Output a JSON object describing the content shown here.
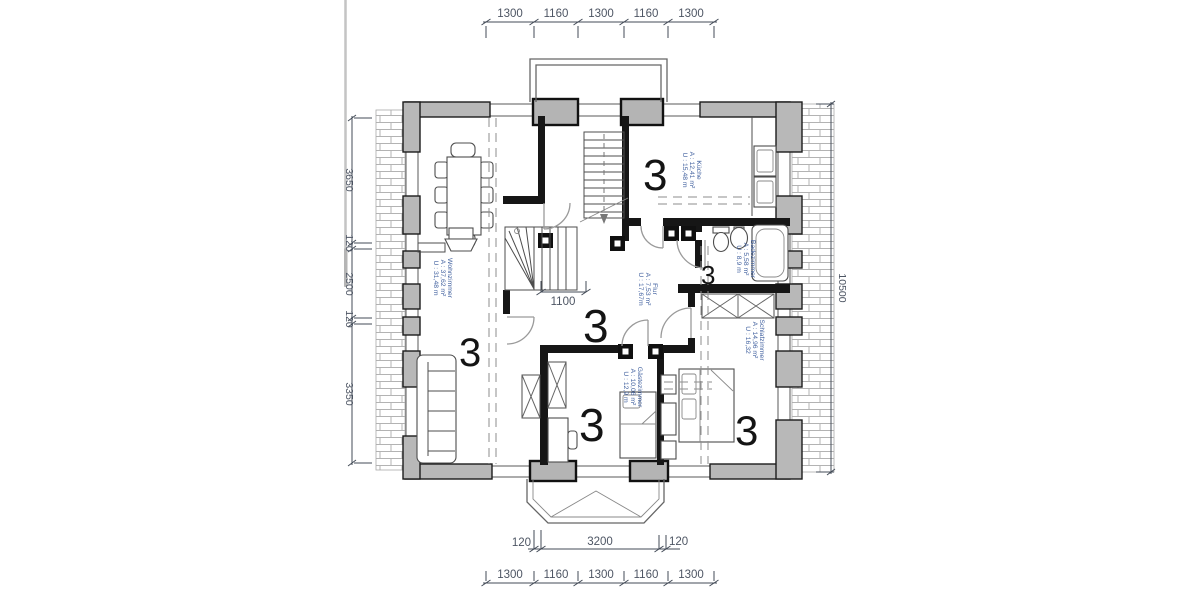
{
  "page": {
    "background": "#ffffff",
    "divider_line_color": "#c4c4c4"
  },
  "drawing": {
    "dimensions": {
      "top": [
        "1300",
        "1160",
        "1300",
        "1160",
        "1300"
      ],
      "bottom_upper": [
        "120",
        "3200",
        "120"
      ],
      "bottom_lower": [
        "1300",
        "1160",
        "1300",
        "1160",
        "1300"
      ],
      "left": [
        "3650",
        "120",
        "2500",
        "120",
        "3350"
      ],
      "right_total": "10500",
      "stair_width": "1100"
    },
    "rooms": [
      {
        "name": "Wohnzimmer",
        "area": "A : 37,62 m²",
        "perimeter": "U : 31,48 m",
        "marker": "3"
      },
      {
        "name": "Flur",
        "area": "A : 7,53 m²",
        "perimeter": "U : 17,67m",
        "marker": "3"
      },
      {
        "name": "Küche",
        "area": "A : 12,41 m²",
        "perimeter": "U : 15,48 m",
        "marker": "3"
      },
      {
        "name": "Badezimmer",
        "area": "A : 5,58 m²",
        "perimeter": "U : 8,9 m",
        "marker": "3"
      },
      {
        "name": "Schlafzimmer",
        "area": "A : 14,96 m²",
        "perimeter": "U : 16,32",
        "marker": "3"
      },
      {
        "name": "Gästezimmer",
        "area": "A : 10,06 m²",
        "perimeter": "U : 12,9 m",
        "marker": "3"
      }
    ],
    "colors": {
      "wall_fill": "#b8b8b8",
      "wall_outline": "#1c1c1c",
      "interior_wall": "#161616",
      "dimension_text": "#4d5563",
      "room_label_text": "#3f5f9e",
      "marker_text": "#141414",
      "hatch_line": "#b3b3b3",
      "door_arc": "#9a9a9a"
    }
  }
}
